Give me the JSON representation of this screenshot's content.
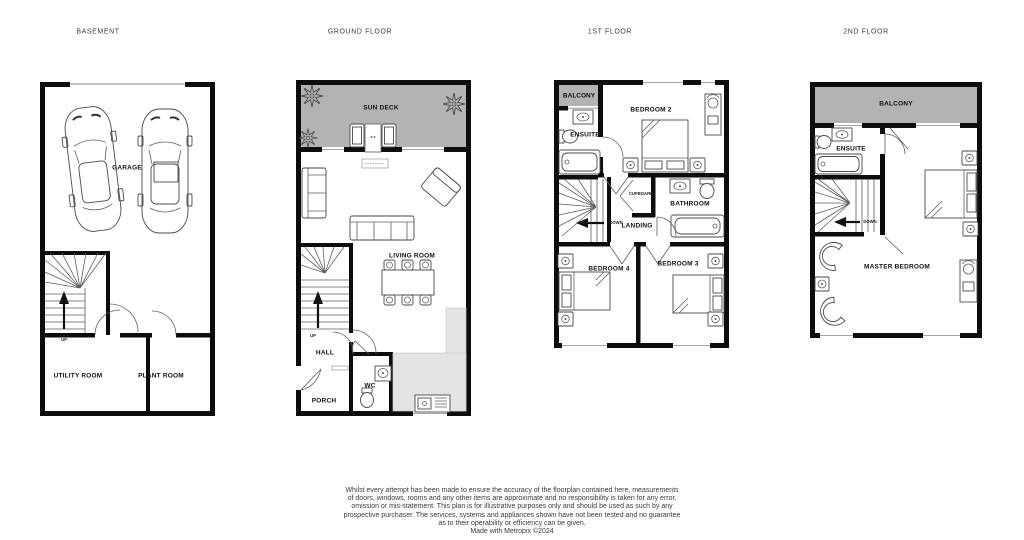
{
  "colors": {
    "deck": "#b3b3b3",
    "counter": "#e4e4e4",
    "wall": "#0d0d0d"
  },
  "floors": [
    {
      "title": "BASEMENT",
      "rooms": {
        "garage": "GARAGE",
        "utility": "UTILITY ROOM",
        "plant": "PLANT ROOM"
      },
      "stairs": "UP"
    },
    {
      "title": "GROUND FLOOR",
      "rooms": {
        "sundeck": "SUN DECK",
        "living": "LIVING ROOM",
        "hall": "HALL",
        "wc": "WC",
        "porch": "PORCH"
      },
      "stairs": "UP"
    },
    {
      "title": "1ST FLOOR",
      "rooms": {
        "balcony": "BALCONY",
        "ensuite": "ENSUITE",
        "bedroom2": "BEDROOM 2",
        "cupboard": "CUPBOARD",
        "bathroom": "BATHROOM",
        "landing": "LANDING",
        "bedroom4": "BEDROOM 4",
        "bedroom3": "BEDROOM 3"
      },
      "stairs": "DOWN"
    },
    {
      "title": "2ND FLOOR",
      "rooms": {
        "balcony": "BALCONY",
        "ensuite": "ENSUITE",
        "master": "MASTER BEDROOM"
      },
      "stairs": "DOWN"
    }
  ],
  "footer": {
    "lines": [
      "Whilst every attempt has been made to ensure the accuracy of the floorplan contained here, measurements",
      "of doors, windows, rooms and any other items are approximate and no responsibility is taken for any error,",
      "omission or mis-statement. This plan is for illustrative purposes only and should be used as such by any",
      "prospective purchaser. The services, systems and appliances shown have not been tested and no guarantee",
      "as to their operability or efficiency can be given.",
      "Made with Metropix ©2024"
    ]
  }
}
